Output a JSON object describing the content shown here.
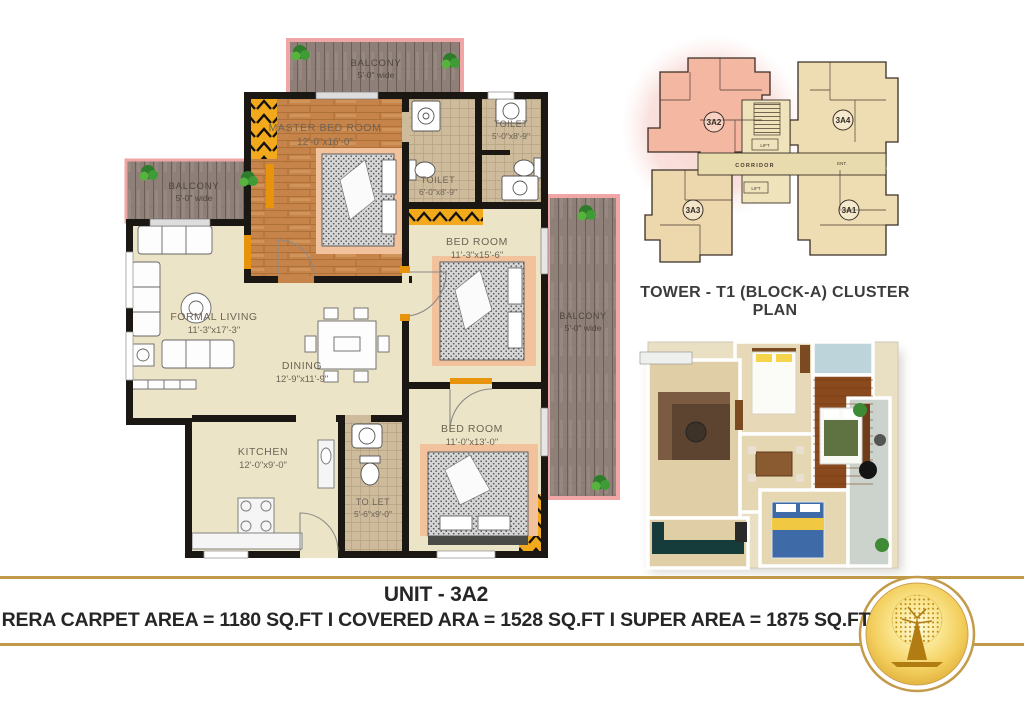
{
  "plan": {
    "rooms": {
      "master": {
        "name": "MASTER BED ROOM",
        "size": "12'-0\"x16'-0\""
      },
      "toilet_a": {
        "name": "TOILET",
        "size": "6'-0\"x8'-9\""
      },
      "toilet_b": {
        "name": "TOILET",
        "size": "5'-0\"x8'-9\""
      },
      "bedroom_right": {
        "name": "BED ROOM",
        "size": "11'-3\"x15'-6\""
      },
      "bedroom_bottom": {
        "name": "BED ROOM",
        "size": "11'-0\"x13'-0\""
      },
      "living": {
        "name": "FORMAL LIVING",
        "size": "11'-3\"x17'-3\""
      },
      "dining": {
        "name": "DINING",
        "size": "12'-9\"x11'-9\""
      },
      "kitchen": {
        "name": "KITCHEN",
        "size": "12'-0\"x9'-0\""
      },
      "toilet_bottom": {
        "name": "TO LET",
        "size": "5'-6\"x9'-0\""
      },
      "balcony_top": {
        "name": "BALCONY",
        "size": "5'-0\" wide"
      },
      "balcony_left": {
        "name": "BALCONY",
        "size": "5'-0\" wide"
      },
      "balcony_right": {
        "name": "BALCONY",
        "size": "5'-0\" wide"
      }
    }
  },
  "cluster": {
    "title": "TOWER - T1 (BLOCK-A) CLUSTER PLAN",
    "unit_highlight": "3A2",
    "unit_top_right": "3A4",
    "unit_bottom_right": "3A1",
    "unit_bottom_left": "3A3",
    "corridor": "CORRIDOR",
    "lift1": "LIFT",
    "lift2": "LIFT",
    "ent": "ENT."
  },
  "footer": {
    "unit": "UNIT - 3A2",
    "areas": "RERA CARPET AREA = 1180 SQ.FT  I  COVERED ARA = 1528 SQ.FT  I  SUPER AREA = 1875 SQ.FT",
    "logo_icon": "golden-tree-logo"
  },
  "colors": {
    "accent_gold": "#c09a48",
    "highlight_unit_pink": "#f4b8a2",
    "wall_black": "#1b1713",
    "wood_floor": "#c6844a",
    "deck_wood": "#8e8078"
  }
}
